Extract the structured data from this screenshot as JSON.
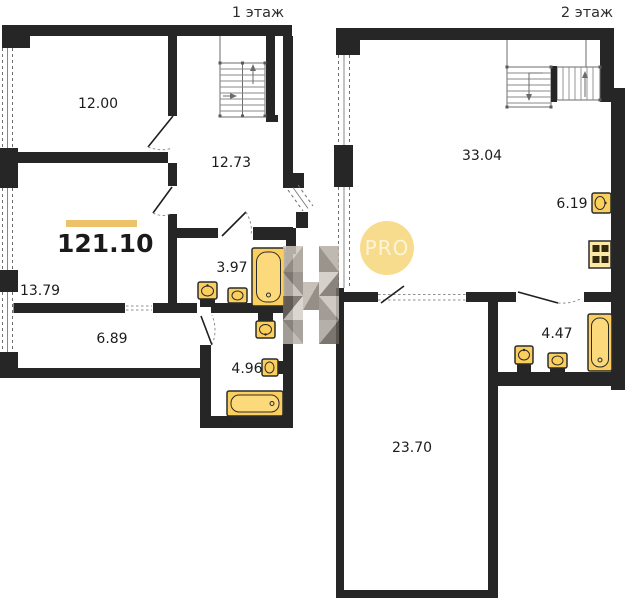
{
  "plan": {
    "floors": [
      {
        "label": "1 этаж",
        "total_area": "121.10",
        "rooms": [
          {
            "name": "bedroom",
            "area": "12.00"
          },
          {
            "name": "hall-with-stairs",
            "area": "12.73"
          },
          {
            "name": "room",
            "area": "13.79"
          },
          {
            "name": "corridor",
            "area": "6.89"
          },
          {
            "name": "bathroom-small",
            "area": "3.97"
          },
          {
            "name": "bathroom-large",
            "area": "4.96"
          }
        ]
      },
      {
        "label": "2 этаж",
        "rooms": [
          {
            "name": "living-room",
            "area": "33.04"
          },
          {
            "name": "kitchen",
            "area": "6.19"
          },
          {
            "name": "bathroom",
            "area": "4.47"
          },
          {
            "name": "room",
            "area": "23.70"
          }
        ]
      }
    ],
    "watermark_badge": "PRO",
    "colors": {
      "wall": "#262626",
      "fixture_fill": "#fbcf5d",
      "fixture_inner": "#fcd97a",
      "stove_fill": "#fce9a6",
      "area_bar": "#edc26b",
      "pro_badge_bg": "#f7d67a",
      "pro_badge_text": "#fdf3d2",
      "label_text": "#1c1c1c"
    }
  }
}
